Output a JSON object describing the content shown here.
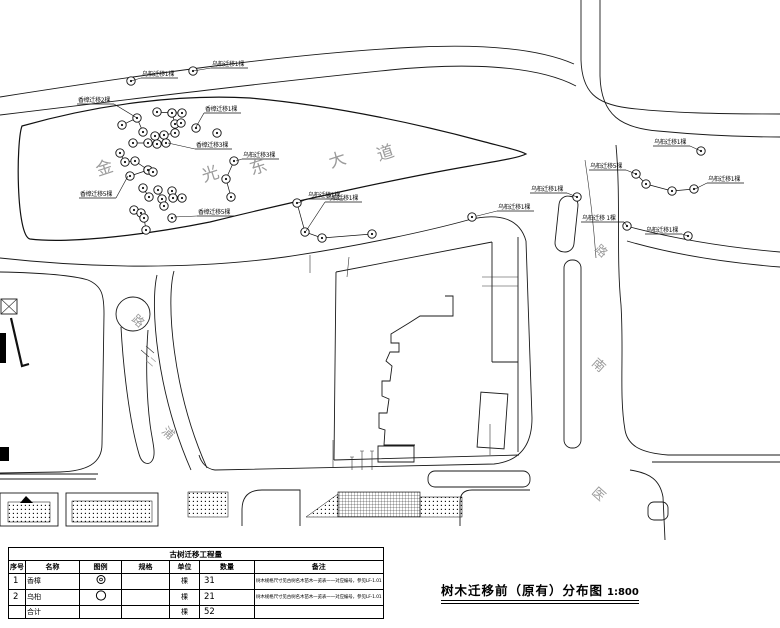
{
  "drawing": {
    "title": "树木迁移前（原有）分布图",
    "scale": "1:800"
  },
  "table": {
    "title": "古树迁移工程量",
    "columns": [
      "序号",
      "名称",
      "图例",
      "规格",
      "单位",
      "数量",
      "备注"
    ],
    "rows": [
      {
        "no": "1",
        "name": "香樟",
        "legend": "double-circle",
        "spec": "",
        "unit": "棵",
        "qty": "31",
        "note": "树木规格尺寸见古树名木苗木一览表一一对应编号，参见LF-1.01"
      },
      {
        "no": "2",
        "name": "乌桕",
        "legend": "circle",
        "spec": "",
        "unit": "棵",
        "qty": "21",
        "note": "树木规格尺寸见古树名木苗木一览表一一对应编号，参见LF-1.01"
      },
      {
        "no": "",
        "name": "合计",
        "legend": "",
        "spec": "",
        "unit": "棵",
        "qty": "52",
        "note": ""
      }
    ]
  },
  "map": {
    "street_names": [
      {
        "text": "金",
        "x": 98,
        "y": 176,
        "rot": -18,
        "size": 17
      },
      {
        "text": "光",
        "x": 204,
        "y": 182,
        "rot": -18,
        "size": 17
      },
      {
        "text": "东",
        "x": 252,
        "y": 175,
        "rot": -18,
        "size": 17
      },
      {
        "text": "大",
        "x": 331,
        "y": 168,
        "rot": -18,
        "size": 17
      },
      {
        "text": "道",
        "x": 379,
        "y": 161,
        "rot": -18,
        "size": 17
      },
      {
        "text": "路",
        "x": 131,
        "y": 320,
        "rot": 42,
        "size": 12
      },
      {
        "text": "二",
        "x": 146,
        "y": 361,
        "rot": 42,
        "size": 9
      },
      {
        "text": "浦",
        "x": 161,
        "y": 432,
        "rot": 42,
        "size": 12
      },
      {
        "text": "路",
        "x": 594,
        "y": 250,
        "rot": 42,
        "size": 12
      },
      {
        "text": "南",
        "x": 591,
        "y": 364,
        "rot": 42,
        "size": 13
      },
      {
        "text": "医",
        "x": 591,
        "y": 493,
        "rot": 42,
        "size": 13
      }
    ],
    "tree_labels": [
      {
        "text": "乌桕迁移1棵",
        "x": 142,
        "y": 76,
        "ax": 131,
        "ay": 81
      },
      {
        "text": "乌桕迁移1棵",
        "x": 212,
        "y": 66,
        "ax": 193,
        "ay": 71
      },
      {
        "text": "香樟迁移2棵",
        "x": 78,
        "y": 102,
        "ax": 137,
        "ay": 118
      },
      {
        "text": "香樟迁移1棵",
        "x": 205,
        "y": 111,
        "ax": 196,
        "ay": 127
      },
      {
        "text": "香樟迁移3棵",
        "x": 196,
        "y": 147,
        "ax": 168,
        "ay": 143
      },
      {
        "text": "乌桕迁移3棵",
        "x": 243,
        "y": 157,
        "ax": 236,
        "ay": 161
      },
      {
        "text": "香樟迁移5棵",
        "x": 80,
        "y": 196,
        "ax": 128,
        "ay": 176
      },
      {
        "text": "香樟迁移5棵",
        "x": 198,
        "y": 214,
        "ax": 174,
        "ay": 217
      },
      {
        "text": "乌桕迁移1棵",
        "x": 308,
        "y": 197,
        "ax": 298,
        "ay": 203
      },
      {
        "text": "乌桕迁移1棵",
        "x": 326,
        "y": 200,
        "ax": 306,
        "ay": 231
      },
      {
        "text": "乌桕迁移1棵",
        "x": 531,
        "y": 191,
        "ax": 577,
        "ay": 197
      },
      {
        "text": "乌桕迁移1棵",
        "x": 498,
        "y": 209,
        "ax": 477,
        "ay": 216
      },
      {
        "text": "乌桕迁移 1棵",
        "x": 582,
        "y": 220,
        "ax": 627,
        "ay": 226
      },
      {
        "text": "乌桕迁移1棵",
        "x": 646,
        "y": 232,
        "ax": 688,
        "ay": 236
      },
      {
        "text": "乌桕迁移1棵",
        "x": 654,
        "y": 144,
        "ax": 701,
        "ay": 151
      },
      {
        "text": "乌桕迁移5棵",
        "x": 590,
        "y": 168,
        "ax": 636,
        "ay": 174
      },
      {
        "text": "乌桕迁移1棵",
        "x": 708,
        "y": 181,
        "ax": 695,
        "ay": 189
      }
    ],
    "tree_singles": [
      [
        131,
        81
      ],
      [
        193,
        71
      ],
      [
        217,
        133
      ],
      [
        196,
        128
      ],
      [
        172,
        218
      ],
      [
        472,
        217
      ],
      [
        577,
        197
      ],
      [
        627,
        226
      ],
      [
        688,
        236
      ],
      [
        701,
        151
      ]
    ],
    "tree_chains": [
      [
        [
          122,
          125
        ],
        [
          137,
          118
        ],
        [
          143,
          132
        ]
      ],
      [
        [
          157,
          112
        ],
        [
          172,
          113
        ],
        [
          182,
          113
        ]
      ],
      [
        [
          172,
          113
        ],
        [
          175,
          124
        ],
        [
          181,
          123
        ]
      ],
      [
        [
          155,
          136
        ],
        [
          164,
          135
        ],
        [
          175,
          133
        ]
      ],
      [
        [
          133,
          143
        ],
        [
          148,
          143
        ],
        [
          157,
          144
        ],
        [
          166,
          143
        ]
      ],
      [
        [
          120,
          153
        ],
        [
          125,
          162
        ],
        [
          135,
          161
        ],
        [
          148,
          170
        ]
      ],
      [
        [
          130,
          176
        ],
        [
          148,
          170
        ],
        [
          153,
          172
        ]
      ],
      [
        [
          234,
          161
        ],
        [
          226,
          179
        ],
        [
          231,
          197
        ]
      ],
      [
        [
          143,
          188
        ],
        [
          149,
          197
        ]
      ],
      [
        [
          158,
          190
        ],
        [
          162,
          199
        ],
        [
          164,
          206
        ]
      ],
      [
        [
          172,
          191
        ],
        [
          173,
          198
        ],
        [
          182,
          198
        ]
      ],
      [
        [
          134,
          210
        ],
        [
          141,
          213
        ],
        [
          144,
          218
        ],
        [
          146,
          230
        ]
      ],
      [
        [
          297,
          203
        ],
        [
          305,
          232
        ],
        [
          322,
          238
        ],
        [
          372,
          234
        ]
      ],
      [
        [
          636,
          174
        ],
        [
          646,
          184
        ],
        [
          672,
          191
        ],
        [
          694,
          189
        ]
      ]
    ]
  }
}
